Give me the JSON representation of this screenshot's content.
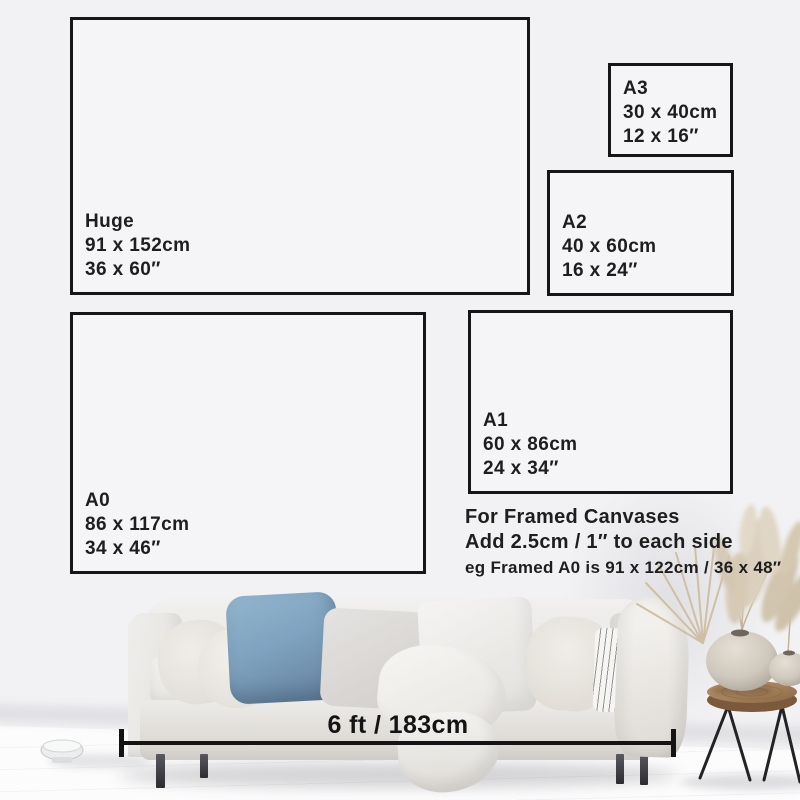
{
  "image": {
    "width": 800,
    "height": 800,
    "background": "#f2f2f4"
  },
  "size_guide": {
    "boxes": [
      {
        "id": "huge",
        "label": "Huge",
        "cm": "91 x 152cm",
        "inches": "36 x 60″"
      },
      {
        "id": "a3",
        "label": "A3",
        "cm": "30 x 40cm",
        "inches": "12 x 16″"
      },
      {
        "id": "a2",
        "label": "A2",
        "cm": "40 x 60cm",
        "inches": "16 x 24″"
      },
      {
        "id": "a0",
        "label": "A0",
        "cm": "86 x 117cm",
        "inches": "34 x 46″"
      },
      {
        "id": "a1",
        "label": "A1",
        "cm": "60 x 86cm",
        "inches": "24 x 34″"
      }
    ],
    "framed_note": {
      "line1": "For Framed Canvases",
      "line2": "Add 2.5cm / 1″ to each side",
      "line3": "eg Framed A0 is 91 x 122cm / 36 x 48″"
    },
    "sofa_width_label": "6 ft / 183cm"
  },
  "scene": {
    "colors": {
      "wall": "#f2f2f4",
      "floor": "#fafafa",
      "line_ink": "#141414",
      "sofa": "#ebe9e6",
      "pillow_blue": "#7fa3c0",
      "table_wood": "#a5815c",
      "vase": "#cfc8bd",
      "pampas": "#d8ccb8",
      "hairpin_legs": "#232326"
    }
  }
}
